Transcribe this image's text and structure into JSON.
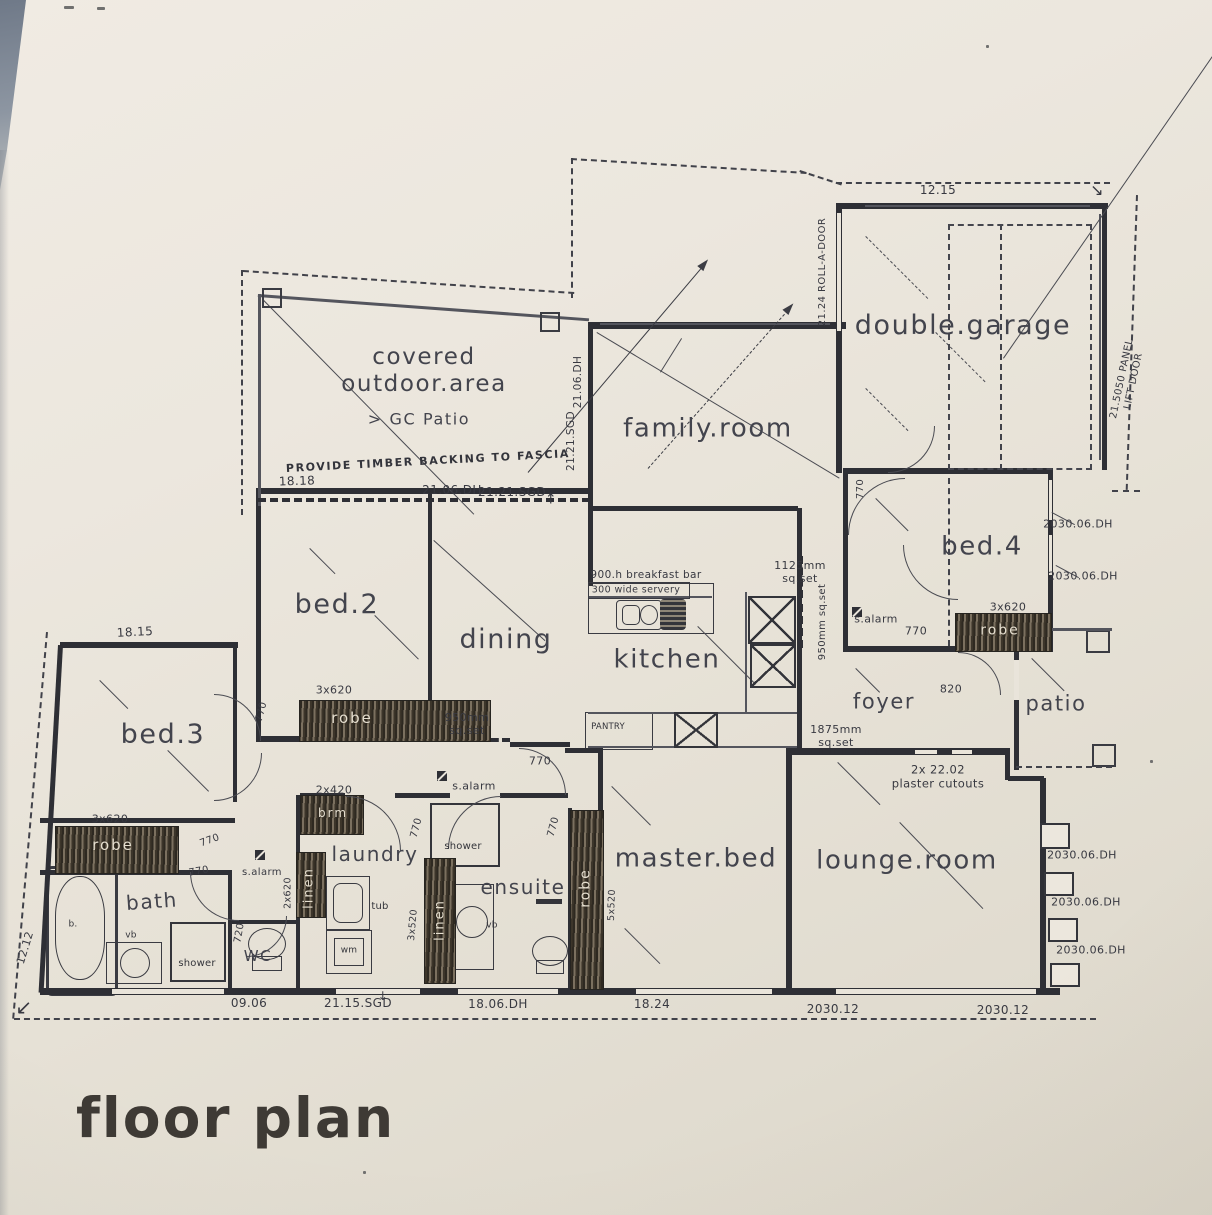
{
  "title": "floor plan",
  "labels": [
    {
      "name": "room-covered-outdoor",
      "text": "covered\noutdoor.area"
    },
    {
      "name": "label-gc-patio",
      "text": "> GC Patio"
    },
    {
      "name": "room-family",
      "text": "family.room"
    },
    {
      "name": "room-garage",
      "text": "double.garage"
    },
    {
      "name": "room-bed4",
      "text": "bed.4"
    },
    {
      "name": "room-patio",
      "text": "patio"
    },
    {
      "name": "room-foyer",
      "text": "foyer"
    },
    {
      "name": "room-kitchen",
      "text": "kitchen"
    },
    {
      "name": "room-dining",
      "text": "dining"
    },
    {
      "name": "room-bed2",
      "text": "bed.2"
    },
    {
      "name": "room-bed3",
      "text": "bed.3"
    },
    {
      "name": "room-bath",
      "text": "bath"
    },
    {
      "name": "room-wc",
      "text": "WC"
    },
    {
      "name": "room-laundry",
      "text": "laundry"
    },
    {
      "name": "room-ensuite",
      "text": "ensuite"
    },
    {
      "name": "room-master",
      "text": "master.bed"
    },
    {
      "name": "room-lounge",
      "text": "lounge.room"
    },
    {
      "name": "robe-bed2",
      "text": "robe"
    },
    {
      "name": "robe-bed3",
      "text": "robe"
    },
    {
      "name": "robe-bed4",
      "text": "robe"
    },
    {
      "name": "robe-master",
      "text": "robe"
    },
    {
      "name": "linen-wc",
      "text": "linen"
    },
    {
      "name": "linen-ensuite",
      "text": "linen"
    },
    {
      "name": "label-brm",
      "text": "brm"
    },
    {
      "name": "label-shower-ensuite",
      "text": "shower"
    },
    {
      "name": "label-shower-bath",
      "text": "shower"
    },
    {
      "name": "label-wm",
      "text": "wm"
    },
    {
      "name": "label-tub",
      "text": "tub"
    },
    {
      "name": "label-vb-ensuite",
      "text": "vb"
    },
    {
      "name": "label-vb-bath",
      "text": "vb"
    },
    {
      "name": "label-bath-b",
      "text": "b."
    },
    {
      "name": "label-pantry",
      "text": "PANTRY"
    },
    {
      "name": "note-fascia",
      "text": "PROVIDE TIMBER BACKING TO FASCIA"
    },
    {
      "name": "dim-1818",
      "text": "18.18"
    },
    {
      "name": "dim-2106dh-bottom",
      "text": "21.06.DH"
    },
    {
      "name": "dim-2121sgd-bottom",
      "text": "21.21.SGD"
    },
    {
      "name": "dim-2106dh-vert",
      "text": "21.06.DH"
    },
    {
      "name": "dim-2121sgd-vert",
      "text": "21.21.SGD"
    },
    {
      "name": "dim-1215",
      "text": "12.15"
    },
    {
      "name": "dim-roll-a-door",
      "text": "21.24 ROLL-A-DOOR"
    },
    {
      "name": "dim-panel-lift-door",
      "text": "21.5050 PANEL LIFT DOOR"
    },
    {
      "name": "dim-2030-bed4-1",
      "text": "2030.06.DH"
    },
    {
      "name": "dim-2030-bed4-2",
      "text": "2030.06.DH"
    },
    {
      "name": "dim-3x620-bed4",
      "text": "3x620"
    },
    {
      "name": "dim-1125-sqset",
      "text": "1125mm\nsq.set"
    },
    {
      "name": "dim-950-sqset-vert",
      "text": "950mm sq.set"
    },
    {
      "name": "label-salarm-foyer",
      "text": "s.alarm"
    },
    {
      "name": "dim-770-foyer",
      "text": "770"
    },
    {
      "name": "dim-770-garage",
      "text": "770"
    },
    {
      "name": "dim-820",
      "text": "820"
    },
    {
      "name": "dim-1875-sqset",
      "text": "1875mm\nsq.set"
    },
    {
      "name": "note-plaster-cutouts",
      "text": "2x  22.02\nplaster cutouts"
    },
    {
      "name": "note-breakfast-bar",
      "text": "900.h breakfast bar"
    },
    {
      "name": "note-servery",
      "text": "300 wide servery"
    },
    {
      "name": "dim-950-sqset-dining",
      "text": "950mm\nsq.set"
    },
    {
      "name": "dim-770-hall",
      "text": "770"
    },
    {
      "name": "label-salarm-hall",
      "text": "s.alarm"
    },
    {
      "name": "dim-770-bed2",
      "text": "770"
    },
    {
      "name": "dim-1815",
      "text": "18.15"
    },
    {
      "name": "dim-770-bed3",
      "text": "770"
    },
    {
      "name": "dim-3x620-bed3",
      "text": "3x620"
    },
    {
      "name": "label-salarm-bed3",
      "text": "s.alarm"
    },
    {
      "name": "dim-770-bath",
      "text": "770"
    },
    {
      "name": "dim-2x420",
      "text": "2x420"
    },
    {
      "name": "dim-2x620",
      "text": "2x620"
    },
    {
      "name": "dim-3x520",
      "text": "3x520"
    },
    {
      "name": "dim-5x520",
      "text": "5x520"
    },
    {
      "name": "dim-770-laundry",
      "text": "770"
    },
    {
      "name": "dim-770-ensuite",
      "text": "770"
    },
    {
      "name": "dim-720-wc",
      "text": "720"
    },
    {
      "name": "dim-3x620-bed2",
      "text": "3x620"
    },
    {
      "name": "dim-1212",
      "text": "12.12"
    },
    {
      "name": "dim-0906",
      "text": "09.06"
    },
    {
      "name": "dim-2115sgd",
      "text": "21.15.SGD"
    },
    {
      "name": "dim-1806dh",
      "text": "18.06.DH"
    },
    {
      "name": "dim-1824",
      "text": "18.24"
    },
    {
      "name": "dim-203012-a",
      "text": "2030.12"
    },
    {
      "name": "dim-203012-b",
      "text": "2030.12"
    },
    {
      "name": "dim-2030-lounge-1",
      "text": "2030.06.DH"
    },
    {
      "name": "dim-2030-lounge-2",
      "text": "2030.06.DH"
    },
    {
      "name": "dim-2030-lounge-3",
      "text": "2030.06.DH"
    },
    {
      "name": "arrow-up-covered",
      "text": "↑"
    },
    {
      "name": "arrow-corner-bottom-left",
      "text": "↙"
    },
    {
      "name": "arrow-corner-garage",
      "text": "↘"
    },
    {
      "name": "arrow-down-laundry",
      "text": "↓"
    }
  ],
  "colors": {
    "paper": "#eae5db",
    "ink": "#2e2f35",
    "hatch": "#5a5143",
    "page_edge": "#8d96a2"
  }
}
